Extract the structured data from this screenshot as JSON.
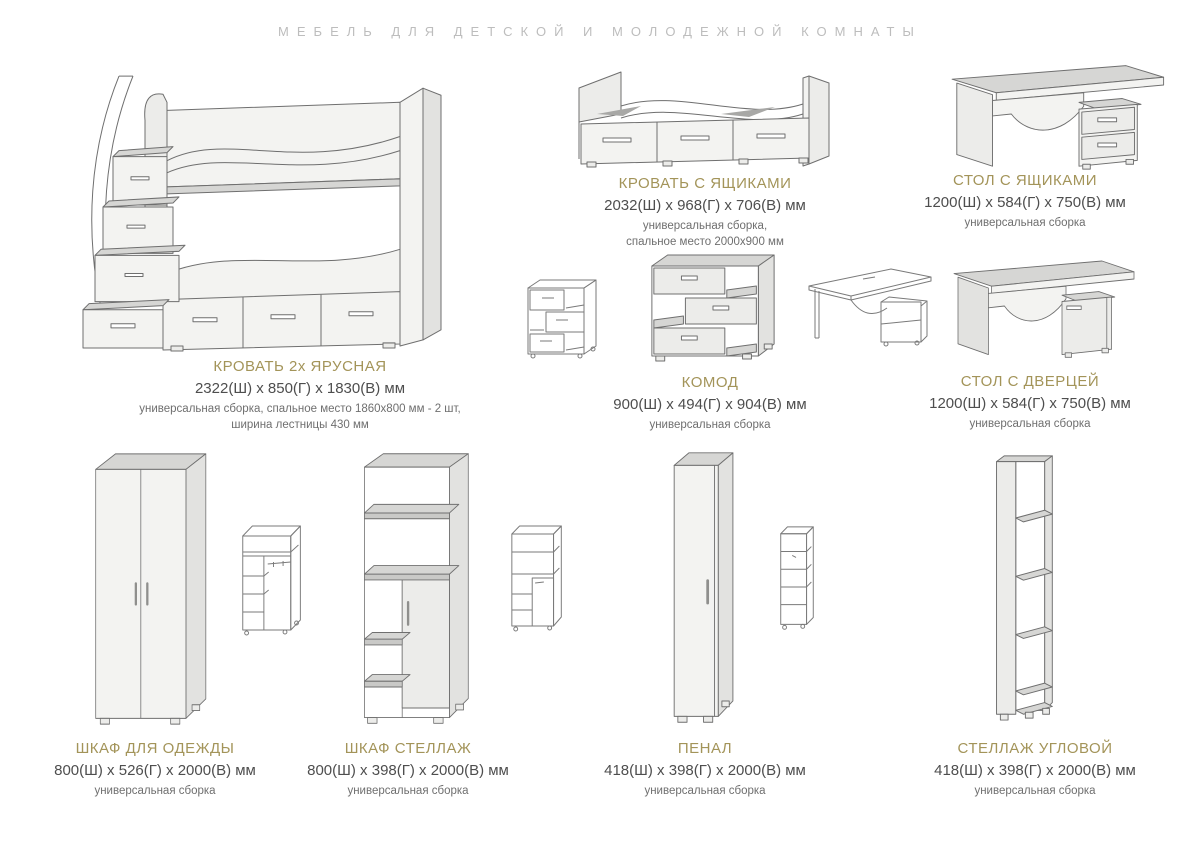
{
  "page": {
    "title": "МЕБЕЛЬ ДЛЯ ДЕТСКОЙ И МОЛОДЕЖНОЙ КОМНАТЫ"
  },
  "colors": {
    "header_text": "#bdbdbd",
    "product_title": "#a39459",
    "dimensions_text": "#4e4e4e",
    "note_text": "#6f6f6f",
    "background": "#ffffff"
  },
  "products": [
    {
      "id": "bunk-bed",
      "name": "КРОВАТЬ 2х ЯРУСНАЯ",
      "dims": "2322(Ш) x 850(Г) x 1830(В) мм",
      "note1": "универсальная сборка, спальное место 1860х800 мм - 2 шт,",
      "note2": "ширина лестницы 430 мм"
    },
    {
      "id": "bed-with-drawers",
      "name": "КРОВАТЬ С ЯЩИКАМИ",
      "dims": "2032(Ш) x 968(Г) x 706(В) мм",
      "note1": "универсальная сборка,",
      "note2": "спальное место 2000х900 мм"
    },
    {
      "id": "desk-with-drawers",
      "name": "СТОЛ С ЯЩИКАМИ",
      "dims": "1200(Ш) x 584(Г) x 750(В) мм",
      "note1": "универсальная сборка"
    },
    {
      "id": "chest-of-drawers",
      "name": "КОМОД",
      "dims": "900(Ш) x 494(Г) x 904(В) мм",
      "note1": "универсальная сборка"
    },
    {
      "id": "desk-with-door",
      "name": "СТОЛ С ДВЕРЦЕЙ",
      "dims": "1200(Ш) x 584(Г) x 750(В) мм",
      "note1": "универсальная сборка"
    },
    {
      "id": "wardrobe",
      "name": "ШКАФ ДЛЯ ОДЕЖДЫ",
      "dims": "800(Ш) x 526(Г) x 2000(В) мм",
      "note1": "универсальная сборка"
    },
    {
      "id": "shelf-wardrobe",
      "name": "ШКАФ СТЕЛЛАЖ",
      "dims": "800(Ш) x 398(Г) x 2000(В) мм",
      "note1": "универсальная сборка"
    },
    {
      "id": "tall-cabinet",
      "name": "ПЕНАЛ",
      "dims": "418(Ш) x 398(Г) x 2000(В) мм",
      "note1": "универсальная сборка"
    },
    {
      "id": "corner-shelf",
      "name": "СТЕЛЛАЖ УГЛОВОЙ",
      "dims": "418(Ш) x 398(Г) x 2000(В) мм",
      "note1": "универсальная сборка"
    }
  ]
}
